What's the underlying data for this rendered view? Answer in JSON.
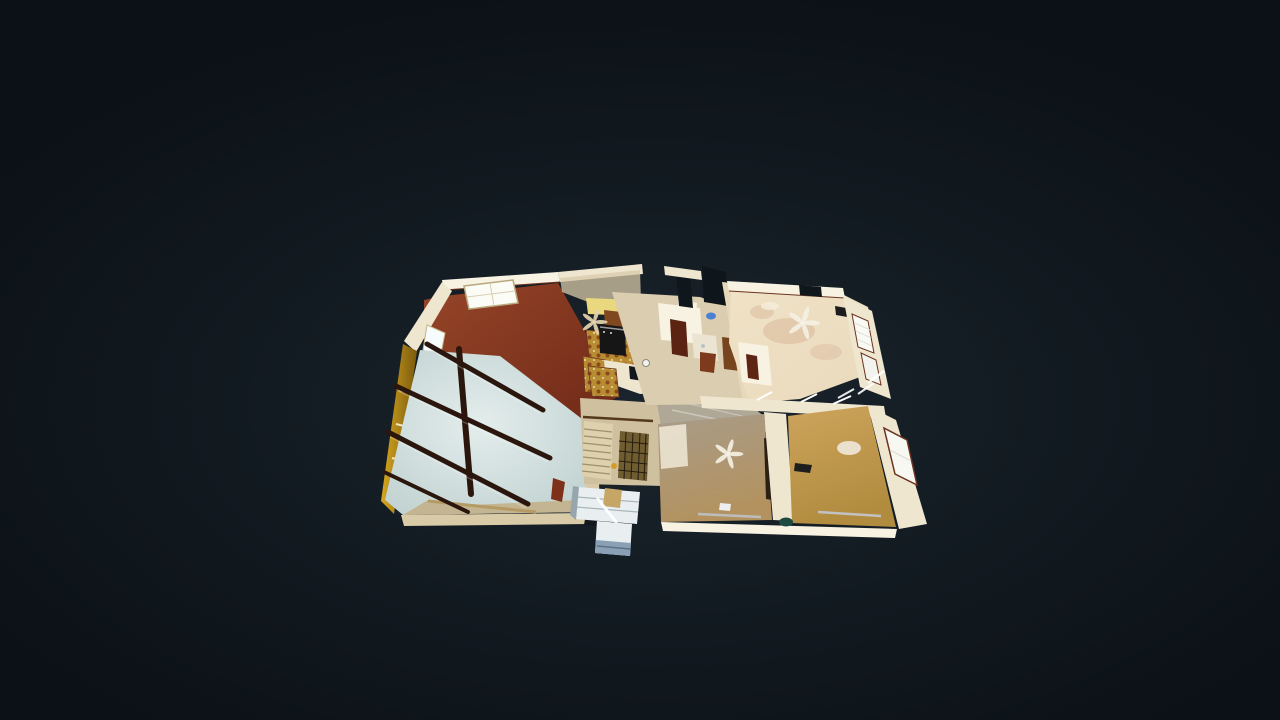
{
  "viewer": {
    "name": "3d-dollhouse-viewer",
    "background_outer": "#0b1116",
    "background_inner": "#1b242d"
  },
  "scene": {
    "kind": "dollhouse-floorplan",
    "description": "Single-story home 3D scan viewed from above at an angle (dollhouse view) centered on a dark backdrop",
    "visible_features": [
      "sunroom with dark roof beams and glowing window band",
      "bedroom with red hardwood floor and two windows",
      "kitchen with black stove, wood cabinets and gold mosaic tile",
      "central staircase with safety gate",
      "hallway with patterned runner rugs",
      "living room with ceiling fan and blinds on right wall",
      "two carpeted bedrooms with baseboard heaters",
      "entry porch steps protruding at bottom"
    ],
    "ceiling_fan_count": 3,
    "colors": {
      "wall": "#efe6cf",
      "wall_bright": "#f8f2e2",
      "wall_shadow": "#d8caa9",
      "trim": "#6b3320",
      "wood": "#964528",
      "wood_dark": "#6e2817",
      "wood_shadow": "#5c2113",
      "ice": "#e3edec",
      "ice_dim": "#c2d3d2",
      "gold": "#d8a820",
      "gold_dark": "#7a5a0e",
      "beam": "#2a160c",
      "carpet_living": "#e9d9bd",
      "blotch": "#d2a98a",
      "carpet_center": "#a89c8a",
      "carpet_center2": "#b3925f",
      "carpet_gold": "#cda45c",
      "carpet_gold2": "#b18c3f",
      "tile": "#b78c33",
      "rosette": "#8a4a1c",
      "stair": "#ddd0ad",
      "gate": "#6f5c30",
      "stove": "#161616",
      "cabinet": "#80481f",
      "porch": "#e9eef1",
      "porch_base": "#8aa0b5",
      "fan": "#f4f0e4",
      "fan_wood": "#e5d3ae",
      "accent_blue": "#4a7fd4",
      "plant": "#1d4a40"
    }
  }
}
